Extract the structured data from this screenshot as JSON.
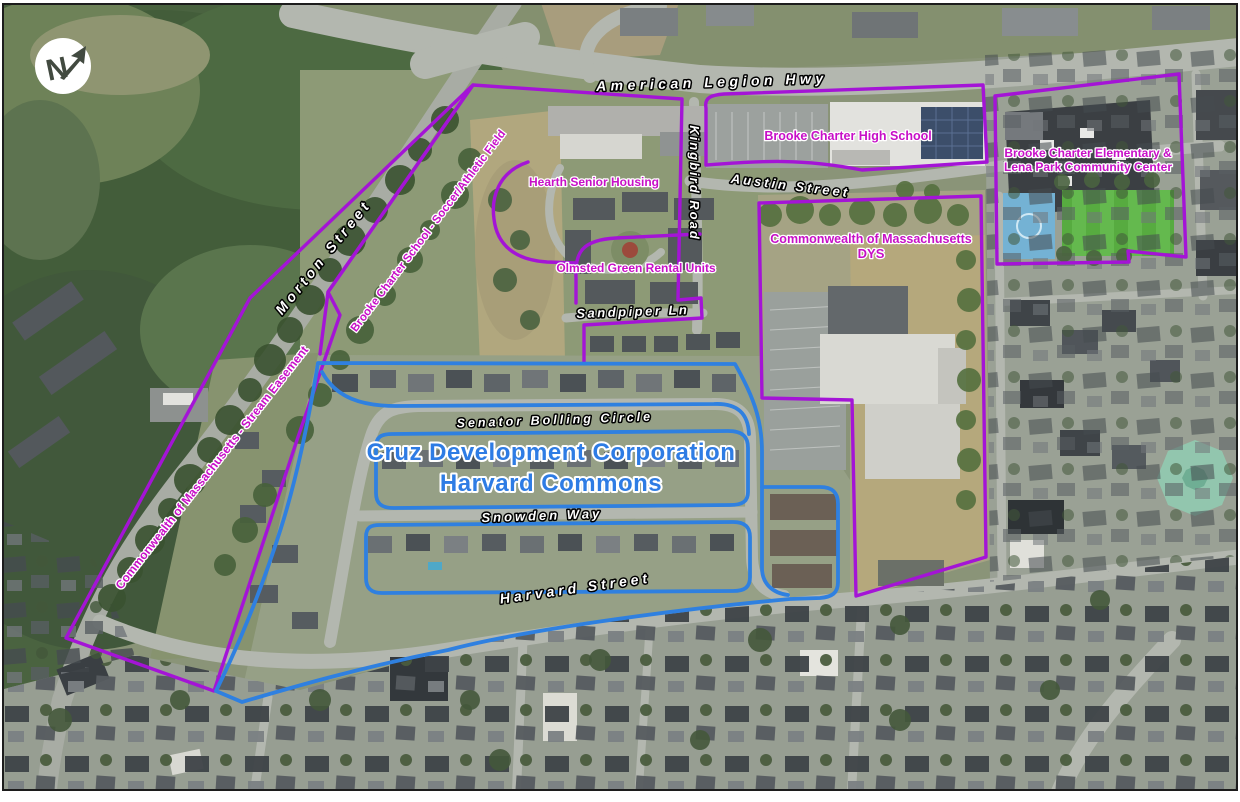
{
  "map_title": "Harvard Commons area aerial parcel map",
  "north_arrow": {
    "letter": "N"
  },
  "colors": {
    "parcel_outline_purple": "#a414d6",
    "parcel_label_magenta": "#c70fc7",
    "development_blue": "#2f80e0",
    "street_label_fill": "#ffffff",
    "street_label_outline": "#000000",
    "field_green": "#57ab40",
    "court_blue": "#74b2d4",
    "octagon_roof_teal": "#92c6ae"
  },
  "streets": [
    {
      "id": "american-legion-hwy",
      "text": "American Legion Hwy"
    },
    {
      "id": "morton-street",
      "text": "Morton Street"
    },
    {
      "id": "kingbird-road",
      "text": "Kingbird Road"
    },
    {
      "id": "austin-street",
      "text": "Austin Street"
    },
    {
      "id": "sandpiper-ln",
      "text": "Sandpiper Ln"
    },
    {
      "id": "senator-bolling-circle",
      "text": "Senator Bolling Circle"
    },
    {
      "id": "snowden-way",
      "text": "Snowden Way"
    },
    {
      "id": "harvard-street",
      "text": "Harvard Street"
    }
  ],
  "parcels": [
    {
      "id": "brooke-charter-high-school",
      "label": "Brooke Charter High School"
    },
    {
      "id": "brooke-charter-elementary",
      "label_line1": "Brooke Charter Elementary &",
      "label_line2": "Lena Park Community Center"
    },
    {
      "id": "hearth-senior-housing",
      "label": "Hearth Senior Housing"
    },
    {
      "id": "olmsted-green-rental-units",
      "label": "Olmsted Green Rental Units"
    },
    {
      "id": "commonwealth-dys",
      "label_line1": "Commonwealth of Massachusetts",
      "label_line2": "DYS"
    },
    {
      "id": "soccer-athletic-field",
      "label": "Brooke Charter School - Soccer/Athletic Field"
    },
    {
      "id": "stream-easement",
      "label": "Commonwealth of Massachusetts - Stream Easement"
    }
  ],
  "development": {
    "line1": "Cruz Development Corporation",
    "line2": "Harvard Commons"
  }
}
